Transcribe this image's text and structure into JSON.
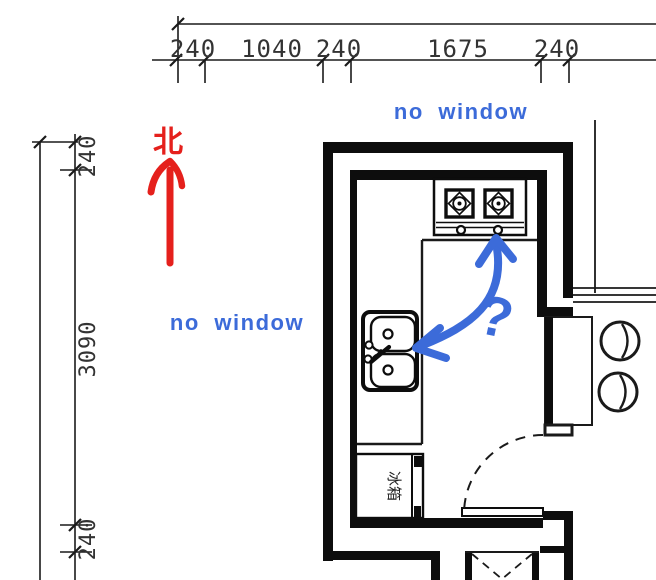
{
  "colors": {
    "line": "#0d0d0d",
    "dim_text": "#333333",
    "annotation_red": "#e5201c",
    "annotation_blue": "#3c6bd9"
  },
  "dimensions": {
    "top": [
      "240",
      "1040",
      "240",
      "1675",
      "240"
    ],
    "left": [
      "240",
      "3090",
      "240"
    ]
  },
  "annotations": {
    "north": "北",
    "no_window_top": "no window",
    "no_window_left": "no window",
    "question": "?"
  },
  "fixtures": {
    "fridge_label": "冰箱"
  }
}
